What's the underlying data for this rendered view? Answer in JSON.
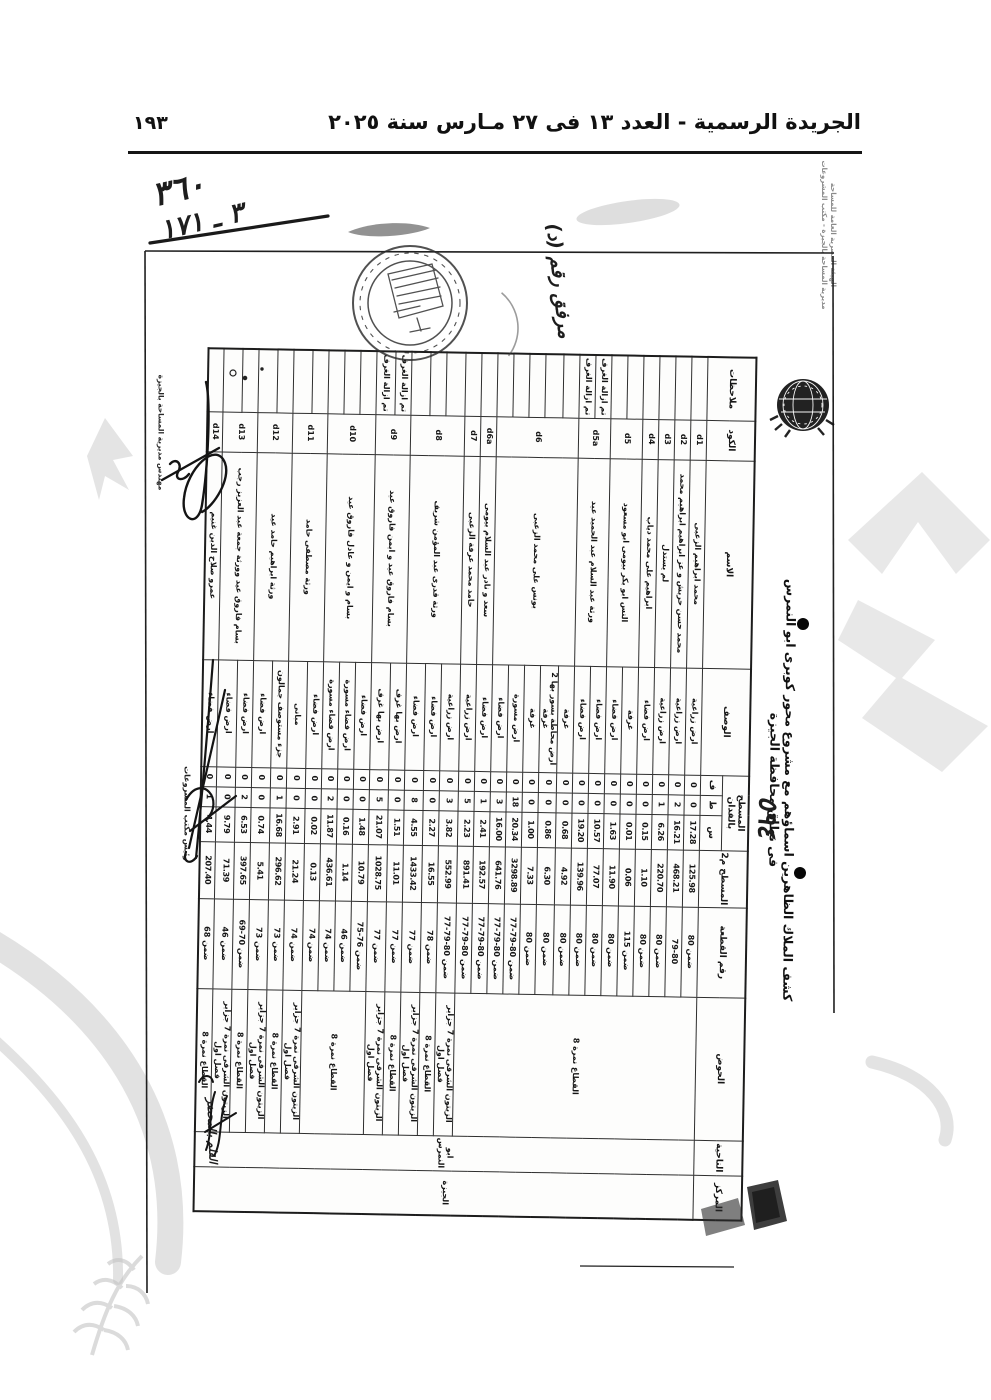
{
  "page": {
    "gazette_header": "الجريدة الرسمية - العدد ١٣ فى ٢٧ مـارس سنة ٢٠٢٥",
    "page_number": "١٩٣"
  },
  "annotations": {
    "handwritten_ref_top": "٣٦٠",
    "handwritten_ref_bottom": "٣ ـ ١٧١",
    "attachment_note": "مرفق رقم (د)",
    "handwritten_number": "٥٩٤",
    "clerk_note": "القلم بالمحضر",
    "signature_title_survey": "مهندس مديرية المساحة بالجيزة",
    "signature_title_projects": "رئيس مكتب المشروعات",
    "agency_line1": "الهيئة المصرية العامة للمساحة",
    "agency_line2": "مديرية المساحة بالجيزة - مكتب المشروعات"
  },
  "icons": {
    "round-official-stamp": "circle-eagle-stamp",
    "survey-authority-emblem": "globe-wreath-emblem",
    "punch-dot": "filled-circle",
    "ink-stamp-smudge": "dark-blob"
  },
  "document": {
    "title": "كشف الملاك الظاهرين اسماؤهم مع مشروع محور كوبرى ابو النمرس فى نطاق محافظة الجيزة",
    "table": {
      "headers": {
        "markaz": "المركز",
        "nahia": "الناحية",
        "basin": "الحوض",
        "plot": "رقم القطعة",
        "area_m2": "المسطح م2",
        "area_feddan": "المسطح بالفدان",
        "f": "ف",
        "t": "ط",
        "s": "س",
        "desc": "الوصف",
        "name": "الاسم",
        "code": "الكود",
        "notes": "ملاحظات"
      },
      "markaz_value": "الجيزة",
      "nahia_value": "ابو النمرس",
      "groups": [
        {
          "code": "d1",
          "name": "محمد ابراهيم الزعبى",
          "rows": [
            {
              "desc": "ارض زراعية",
              "f": "0",
              "t": "0",
              "s": "17.28",
              "m2": "125.98",
              "plot": "ضمن 80",
              "basin": "القطاع نمرة 8",
              "note": ""
            }
          ]
        },
        {
          "code": "d2",
          "name": "محمد حسن حربش و عز ابراهيم ابراهيم محمد",
          "rows": [
            {
              "desc": "ارض زراعية",
              "f": "0",
              "t": "2",
              "s": "16.21",
              "m2": "468.21",
              "plot": "79-80",
              "basin": "القطاع نمرة 8",
              "note": ""
            }
          ]
        },
        {
          "code": "d3",
          "name": "لم يستدل",
          "rows": [
            {
              "desc": "ارض زراعية",
              "f": "0",
              "t": "1",
              "s": "6.26",
              "m2": "220.70",
              "plot": "ضمن 80",
              "basin": "القطاع نمرة 8",
              "note": ""
            }
          ]
        },
        {
          "code": "d4",
          "name": "ابراهيم على محمد دياب",
          "rows": [
            {
              "desc": "ارض فضاء",
              "f": "0",
              "t": "0",
              "s": "0.15",
              "m2": "1.10",
              "plot": "ضمن 80",
              "basin": "القطاع نمرة 8",
              "note": ""
            }
          ]
        },
        {
          "code": "d5",
          "name": "النس ابو بكر بيومى ابو مسعود",
          "rows": [
            {
              "desc": "غرفة",
              "f": "0",
              "t": "0",
              "s": "0.01",
              "m2": "0.06",
              "plot": "ضمن 115",
              "basin": "القطاع نمرة 8",
              "note": ""
            },
            {
              "desc": "ارض فضاء",
              "f": "0",
              "t": "0",
              "s": "1.63",
              "m2": "11.90",
              "plot": "ضمن 80",
              "basin": "القطاع نمرة 8",
              "note": ""
            }
          ]
        },
        {
          "code": "d5a",
          "name": "ورثة عبد السلام عبد الحميد عيد",
          "rows": [
            {
              "desc": "ارض فضاء",
              "f": "0",
              "t": "0",
              "s": "10.57",
              "m2": "77.07",
              "plot": "ضمن 80",
              "basin": "القطاع نمرة 8",
              "note": "تم ازالة الغرف"
            },
            {
              "desc": "ارض فضاء",
              "f": "0",
              "t": "0",
              "s": "19.20",
              "m2": "139.96",
              "plot": "ضمن 80",
              "basin": "القطاع نمرة 8",
              "note": "تم ازالة الغرف"
            }
          ]
        },
        {
          "code": "d6",
          "name": "يونس على محمد الزعبى",
          "rows": [
            {
              "desc": "غرفة",
              "f": "0",
              "t": "0",
              "s": "0.68",
              "m2": "4.92",
              "plot": "ضمن 80",
              "basin": "القطاع نمرة 8",
              "note": ""
            },
            {
              "desc": "ارض محاطة بسور بها 2 غرفة",
              "f": "0",
              "t": "0",
              "s": "0.86",
              "m2": "6.30",
              "plot": "ضمن 80",
              "basin": "القطاع نمرة 8",
              "note": ""
            },
            {
              "desc": "غرفة",
              "f": "0",
              "t": "0",
              "s": "1.00",
              "m2": "7.33",
              "plot": "ضمن 80",
              "basin": "القطاع نمرة 8",
              "note": ""
            },
            {
              "desc": "ارض مسورة",
              "f": "0",
              "t": "18",
              "s": "20.34",
              "m2": "3298.89",
              "plot": "ضمن 80-79-77",
              "basin": "القطاع نمرة 8",
              "note": ""
            },
            {
              "desc": "ارض فضاء",
              "f": "0",
              "t": "3",
              "s": "16.00",
              "m2": "641.76",
              "plot": "ضمن 80-79-77",
              "basin": "القطاع نمرة 8",
              "note": ""
            }
          ]
        },
        {
          "code": "d6a",
          "name": "سعد و نادر عبد السلام بيومى",
          "rows": [
            {
              "desc": "ارض فضاء",
              "f": "0",
              "t": "1",
              "s": "2.41",
              "m2": "192.57",
              "plot": "ضمن 80-79-77",
              "basin": "القطاع نمرة 8",
              "note": ""
            }
          ]
        },
        {
          "code": "d7",
          "name": "حامد محمد عرفة الزعبى",
          "rows": [
            {
              "desc": "ارض زراعية",
              "f": "0",
              "t": "5",
              "s": "2.23",
              "m2": "891.41",
              "plot": "ضمن 80-79-77",
              "basin": "القطاع نمرة 8",
              "note": ""
            }
          ]
        },
        {
          "code": "d8",
          "name": "ورثة قدرى عبد المؤمن شريف",
          "rows": [
            {
              "desc": "ارض زراعية",
              "f": "0",
              "t": "3",
              "s": "3.82",
              "m2": "552.99",
              "plot": "ضمن 80-79-77",
              "basin": "الزيتون الشرقى نمرة 7 جزاير فصل اول",
              "note": ""
            },
            {
              "desc": "ارض فضاء",
              "f": "0",
              "t": "0",
              "s": "2.27",
              "m2": "16.55",
              "plot": "ضمن 78",
              "basin": "القطاع نمرة 8",
              "note": ""
            },
            {
              "desc": "ارض فضاء",
              "f": "0",
              "t": "8",
              "s": "4.55",
              "m2": "1433.42",
              "plot": "ضمن 77",
              "basin": "الزيتون الشرقى نمرة 7 جزاير فصل اول",
              "note": ""
            }
          ]
        },
        {
          "code": "d9",
          "name": "بسام فاروق عيد و ايمن فاروق عيد",
          "rows": [
            {
              "desc": "ارض بها غرف",
              "f": "0",
              "t": "0",
              "s": "1.51",
              "m2": "11.01",
              "plot": "ضمن 77",
              "basin": "القطاع نمرة 8",
              "note": "تم ازالة الغرف"
            },
            {
              "desc": "ارض بها غرف",
              "f": "0",
              "t": "5",
              "s": "21.07",
              "m2": "1028.75",
              "plot": "ضمن 77",
              "basin": "الزيتون الشرقى نمرة 7 جزاير فصل اول",
              "note": "تم ازالة الغرف"
            }
          ]
        },
        {
          "code": "d10",
          "name": "بسام و ايمن و عادل فاروق عيد",
          "rows": [
            {
              "desc": "ارض فضاء",
              "f": "0",
              "t": "0",
              "s": "1.48",
              "m2": "10.79",
              "plot": "ضمن 76-75",
              "basin": "القطاع نمرة 8",
              "note": ""
            },
            {
              "desc": "ارض فضاء مسورة",
              "f": "0",
              "t": "0",
              "s": "0.16",
              "m2": "1.14",
              "plot": "ضمن 46",
              "basin": "القطاع نمرة 8",
              "note": ""
            },
            {
              "desc": "ارض فضاء مسورة",
              "f": "0",
              "t": "2",
              "s": "11.87",
              "m2": "436.61",
              "plot": "ضمن 74",
              "basin": "القطاع نمرة 8",
              "note": ""
            }
          ]
        },
        {
          "code": "d11",
          "name": "ورثة مصطفى حامد",
          "rows": [
            {
              "desc": "ارض فضاء",
              "f": "0",
              "t": "0",
              "s": "0.02",
              "m2": "0.13",
              "plot": "ضمن 74",
              "basin": "القطاع نمرة 8",
              "note": ""
            },
            {
              "desc": "مبانى",
              "f": "0",
              "t": "0",
              "s": "2.91",
              "m2": "21.24",
              "plot": "ضمن 74",
              "basin": "الزيتون الشرقى نمرة 7 جزاير فصل اول",
              "note": ""
            }
          ]
        },
        {
          "code": "d12",
          "name": "ورثة ابراهيم حامد عيد",
          "rows": [
            {
              "desc": "جزء مستوصف جمالون",
              "f": "0",
              "t": "1",
              "s": "16.68",
              "m2": "296.62",
              "plot": "ضمن 73",
              "basin": "القطاع نمرة 8",
              "note": ""
            },
            {
              "desc": "ارض فضاء",
              "f": "0",
              "t": "0",
              "s": "0.74",
              "m2": "5.41",
              "plot": "ضمن 73",
              "basin": "الزيتون الشرقى نمرة 7 جزاير فصل اول",
              "note": ""
            }
          ]
        },
        {
          "code": "d13",
          "name": "بسام فاروق عيد وورثة جمعة عبد العزيز رجب",
          "rows": [
            {
              "desc": "ارض فضاء",
              "f": "0",
              "t": "2",
              "s": "6.53",
              "m2": "397.65",
              "plot": "ضمن 70-69",
              "basin": "القطاع نمرة 8",
              "note": ""
            },
            {
              "desc": "ارض فضاء",
              "f": "0",
              "t": "0",
              "s": "9.79",
              "m2": "71.39",
              "plot": "ضمن 46",
              "basin": "الزيتون الشرقى نمرة 7 جزاير فصل اول",
              "note": ""
            }
          ]
        },
        {
          "code": "d14",
          "name": "عمرو صلاح الدين غنيم",
          "rows": [
            {
              "desc": "ارض فضاء",
              "f": "0",
              "t": "1",
              "s": "4.44",
              "m2": "207.40",
              "plot": "ضمن 68",
              "basin": "القطاع نمرة 8",
              "note": ""
            }
          ]
        }
      ]
    }
  }
}
